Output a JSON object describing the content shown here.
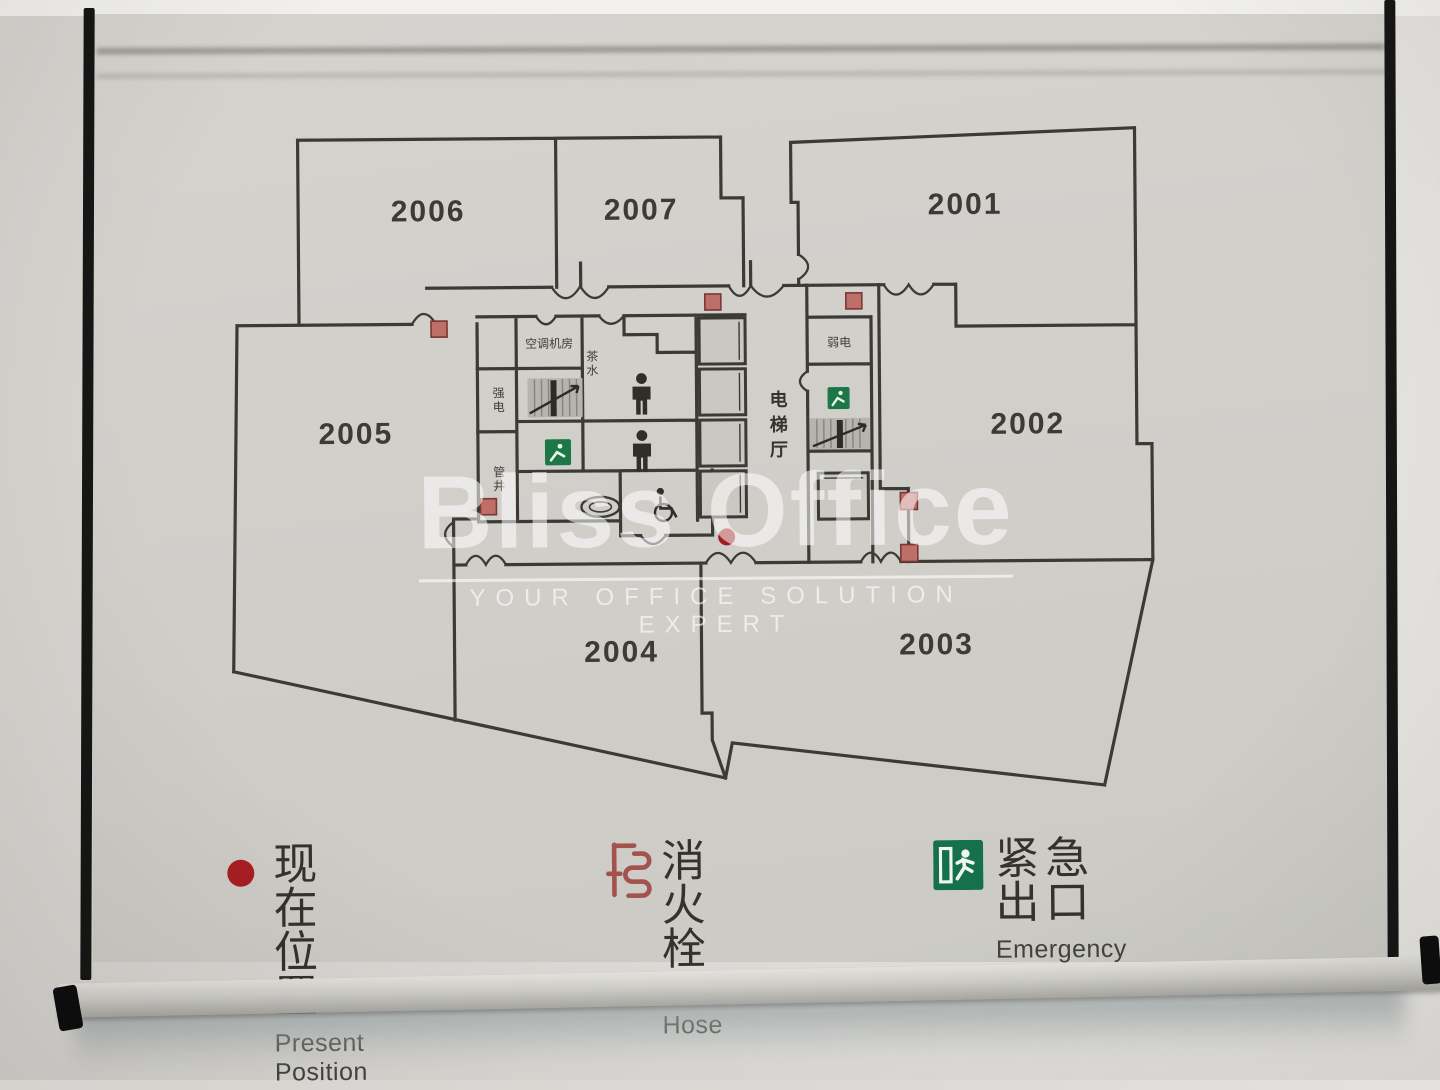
{
  "watermark": {
    "brand": "Bliss Office",
    "tagline": "YOUR OFFICE SOLUTION EXPERT"
  },
  "plan": {
    "rooms": [
      {
        "id": "2006"
      },
      {
        "id": "2007"
      },
      {
        "id": "2001"
      },
      {
        "id": "2005"
      },
      {
        "id": "2002"
      },
      {
        "id": "2004"
      },
      {
        "id": "2003"
      }
    ],
    "core_labels": {
      "ac_room": "空调机房",
      "pantry": "茶水",
      "strong_power": "强电",
      "shaft": "管井",
      "weak_power": "弱电",
      "elevator_hall": "电梯厅"
    }
  },
  "legend": {
    "present": {
      "zh": "现在位置",
      "en": "Present Position"
    },
    "fire": {
      "zh": "消火栓",
      "en": "Fire Hose"
    },
    "exit": {
      "zh": "紧急出口",
      "en": "Emergency Exit"
    }
  },
  "colors": {
    "plan_line": "#3b3a35",
    "present_position_red": "#a81e23",
    "fire_hose_marker_red": "#bd6f68",
    "exit_green": "#1c7747",
    "panel_gray": "#d1cfca"
  }
}
